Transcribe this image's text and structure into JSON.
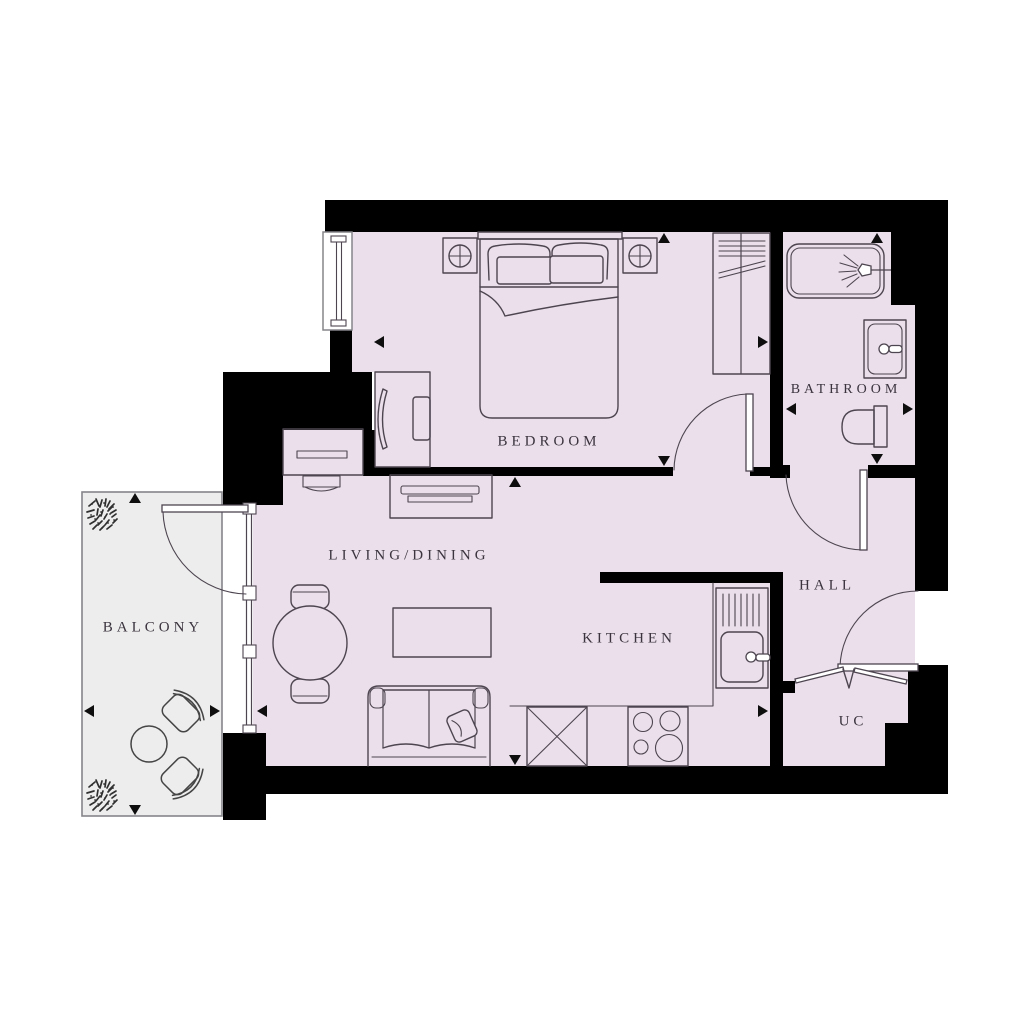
{
  "rooms": {
    "bedroom": {
      "label": "BEDROOM"
    },
    "bathroom": {
      "label": "BATHROOM"
    },
    "living_dining": {
      "label": "LIVING/DINING"
    },
    "kitchen": {
      "label": "KITCHEN"
    },
    "hall": {
      "label": "HALL"
    },
    "uc": {
      "label": "UC"
    },
    "balcony": {
      "label": "BALCONY"
    }
  },
  "colors": {
    "floor": "#eadfeb",
    "balcony": "#ededed",
    "wall": "#000000",
    "line": "#4d4550",
    "label": "#3b343f",
    "outline": "#85858a",
    "arrow": "#0e0e0e"
  },
  "icons": {
    "fixtures": [
      "double-bed",
      "pillows",
      "bedside-table",
      "table-lamp",
      "wardrobe",
      "desk",
      "desk-chair",
      "bathtub",
      "shower-head",
      "wash-basin",
      "toilet",
      "kitchen-sink",
      "hob",
      "appliance-crossed",
      "sofa",
      "cushion",
      "coffee-table",
      "tv-unit",
      "console-table",
      "round-dining-table",
      "dining-chair",
      "balcony-table",
      "balcony-chair",
      "plant",
      "door-swing",
      "bifold-door",
      "window-glazing",
      "dimension-arrow"
    ]
  }
}
